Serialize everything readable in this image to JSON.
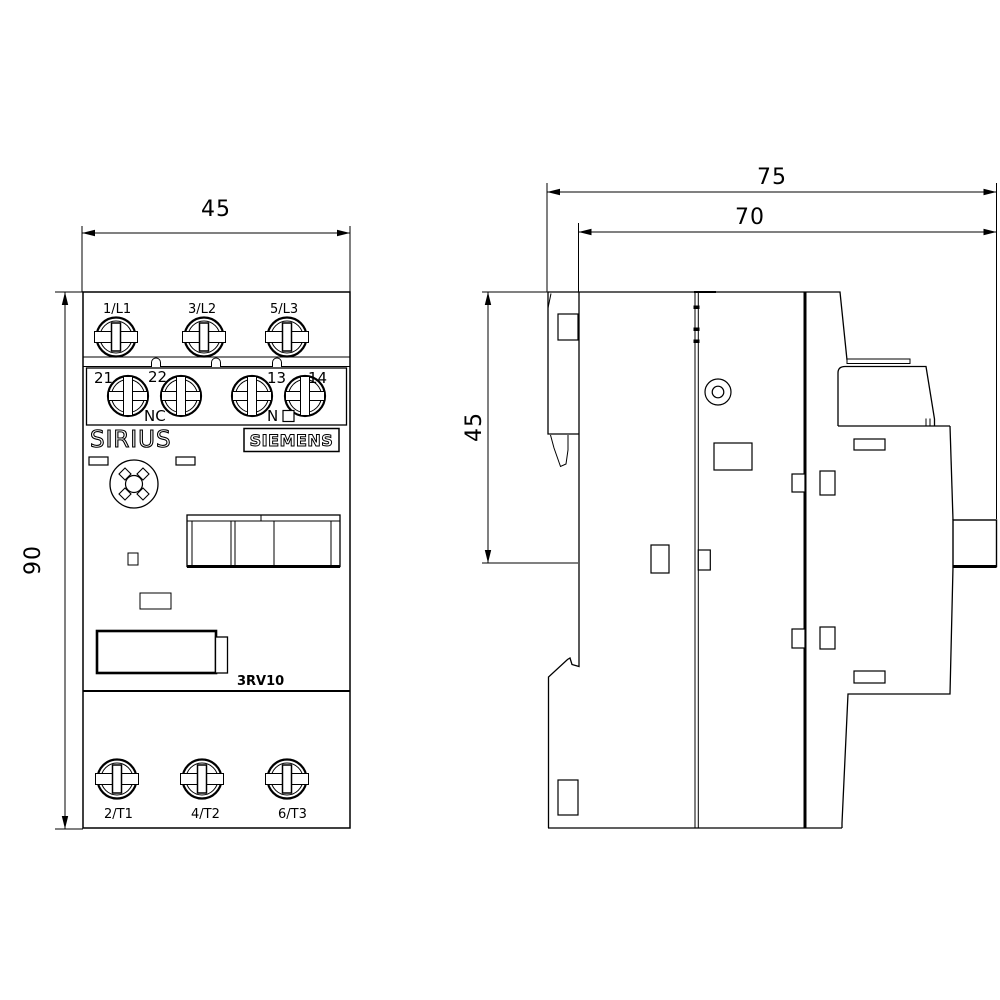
{
  "drawing": {
    "front_view": {
      "brand": "SIRIUS",
      "logo": "SIEMENS",
      "model": "3RV10",
      "top_terminals": [
        "1/L1",
        "3/L2",
        "5/L3"
      ],
      "bottom_terminals": [
        "2/T1",
        "4/T2",
        "6/T3"
      ],
      "aux_terminals": [
        "21",
        "22",
        "13",
        "14"
      ],
      "aux_nc_label": "NC",
      "aux_no_label": "N",
      "dim_width": "45",
      "dim_height": "90"
    },
    "side_view": {
      "dim_overall_depth": "75",
      "dim_body_depth": "70",
      "dim_upper_height": "45"
    },
    "colors": {
      "line": "#000000",
      "background": "#ffffff"
    }
  }
}
